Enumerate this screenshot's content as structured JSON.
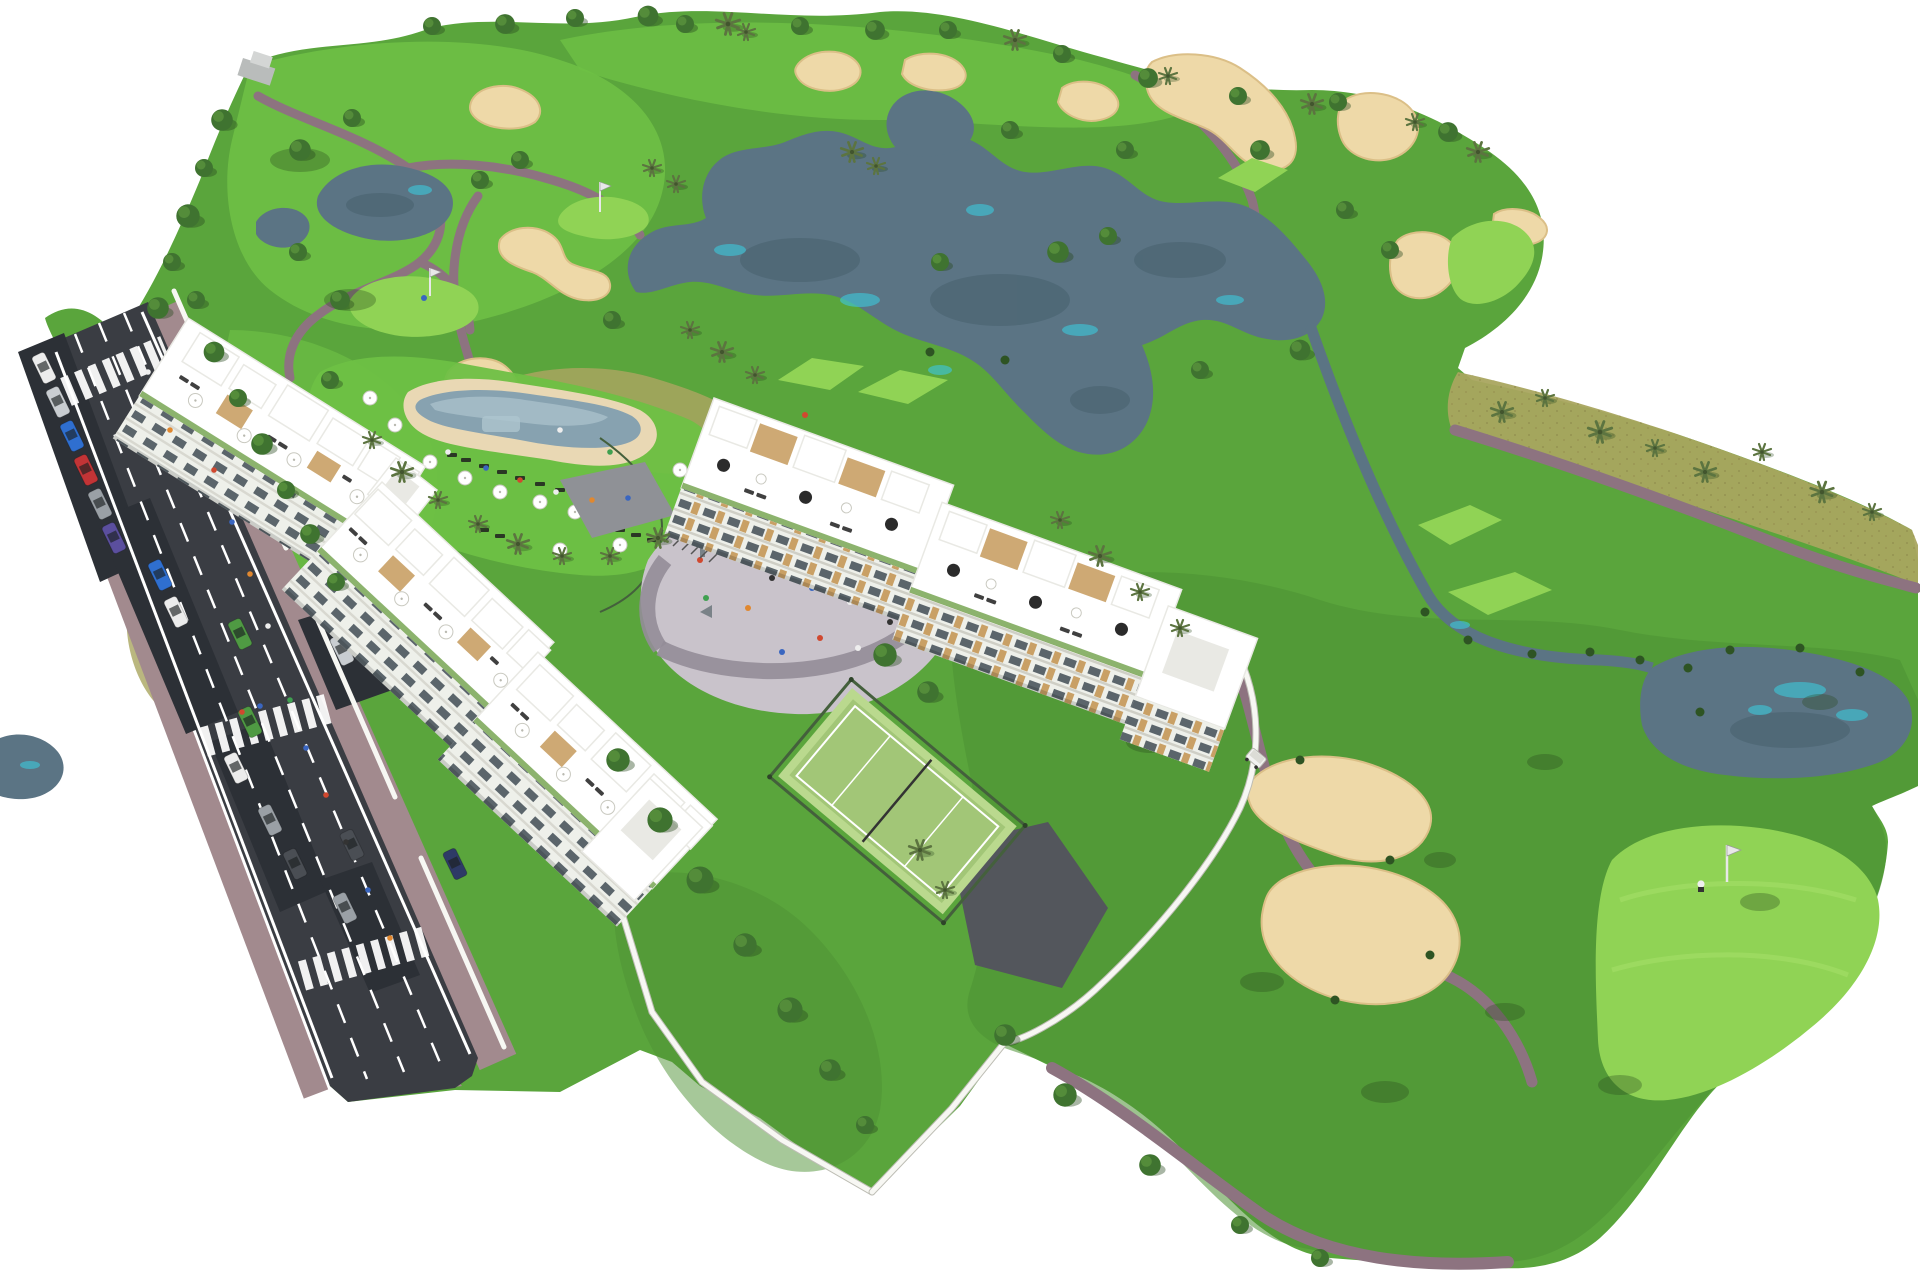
{
  "scene": {
    "type": "aerial-architectural-render",
    "subject": "golf-resort-apartment-development",
    "inventory": {
      "apartment_buildings": 3,
      "communal_pool": 1,
      "paddle_tennis_court": 1,
      "playground_plaza": 1,
      "golf_flags": 3,
      "lakes": 5,
      "sand_bunkers": 12,
      "crosswalks": 3,
      "cars": 19,
      "golf_carts": 1,
      "golfers": 1
    },
    "colors": {
      "bg": "#ffffff",
      "grassBase": "#5aa53c",
      "grassBright": "#6ec045",
      "grassDark": "#4d9133",
      "teeGreen": "#90d355",
      "khaki": "#a9a55f",
      "sand": "#eed9a8",
      "sandShade": "#dbbf87",
      "water": "#5b7484",
      "waterDark": "#47616e",
      "waterTeal": "#3fc3d5",
      "path": "#8d7380",
      "road": "#3a3d43",
      "roadDark": "#2c3036",
      "marking": "#ffffff",
      "sidewalk": "#a28a8e",
      "wall": "#f7f7f3",
      "wallShade": "#bdbdb4",
      "building": "#ffffff",
      "buildingShade": "#e9e9e4",
      "facade": "#eef0ea",
      "window": "#46525a",
      "wood": "#c9a065",
      "planter": "#6fa049",
      "umbrella": "#ffffff",
      "umbrellaDark": "#2b2b2b",
      "lounger": "#1f1f1f",
      "tree": "#3f7330",
      "treeDark": "#2e5423",
      "treeLight": "#578f3c",
      "palm": "#5c7440",
      "shadow": "#27481d",
      "plaza": "#c9c3cb",
      "plazaRing": "#948d98",
      "court": "#bad98e",
      "courtDark": "#a2c677",
      "fence": "#44603c",
      "asphalt": "#53565c",
      "poolWater": "#87a2b0",
      "poolLight": "#aec5ce",
      "deck": "#e9d8b4",
      "cart": "#f2f2f0",
      "flag": "#e8e8e8",
      "carWhite": "#ececec",
      "carSilver": "#c9cdd1",
      "carGray": "#9aa0a6",
      "carDark": "#4a4e54",
      "carNavy": "#2e3a66",
      "carBlue": "#2f6fd0",
      "carRed": "#c23436",
      "carGreen": "#4f9a43",
      "carPurple": "#5b4f9e",
      "carBrown": "#7a5c40",
      "personRed": "#d0482f",
      "personBlue": "#3a66c0",
      "personWhite": "#eeeeee",
      "personGreen": "#3fa050",
      "personOrange": "#e08830",
      "personDark": "#333333"
    }
  }
}
